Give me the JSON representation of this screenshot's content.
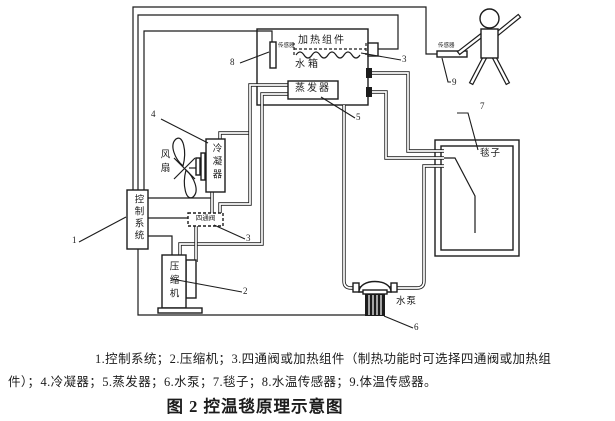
{
  "colors": {
    "ink": "#1c1c1c",
    "bg": "#ffffff"
  },
  "diagram": {
    "labels": {
      "heating_component": "加热组件",
      "water_tank": "水箱",
      "evaporator": "蒸发器",
      "water_temp_sensor": "传感器",
      "body_temp_sensor": "传感器",
      "fan": "风扇",
      "condenser": "冷凝器",
      "control_system": "控制系统",
      "four_way_valve": "四通阀",
      "compressor": "压缩机",
      "water_pump": "水泵",
      "blanket": "毯子"
    },
    "callouts": {
      "n1": "1",
      "n2": "2",
      "n3_valve": "3",
      "n3_heater": "3",
      "n4": "4",
      "n5": "5",
      "n6": "6",
      "n7": "7",
      "n8": "8",
      "n9": "9"
    }
  },
  "caption": {
    "line1": "1.控制系统；2.压缩机；3.四通阀或加热组件（制热功能时可选择四通阀或加热组",
    "line2": "件）；4.冷凝器；5.蒸发器；6.水泵；7.毯子；8.水温传感器；9.体温传感器。"
  },
  "figure_title": "图 2 控温毯原理示意图"
}
